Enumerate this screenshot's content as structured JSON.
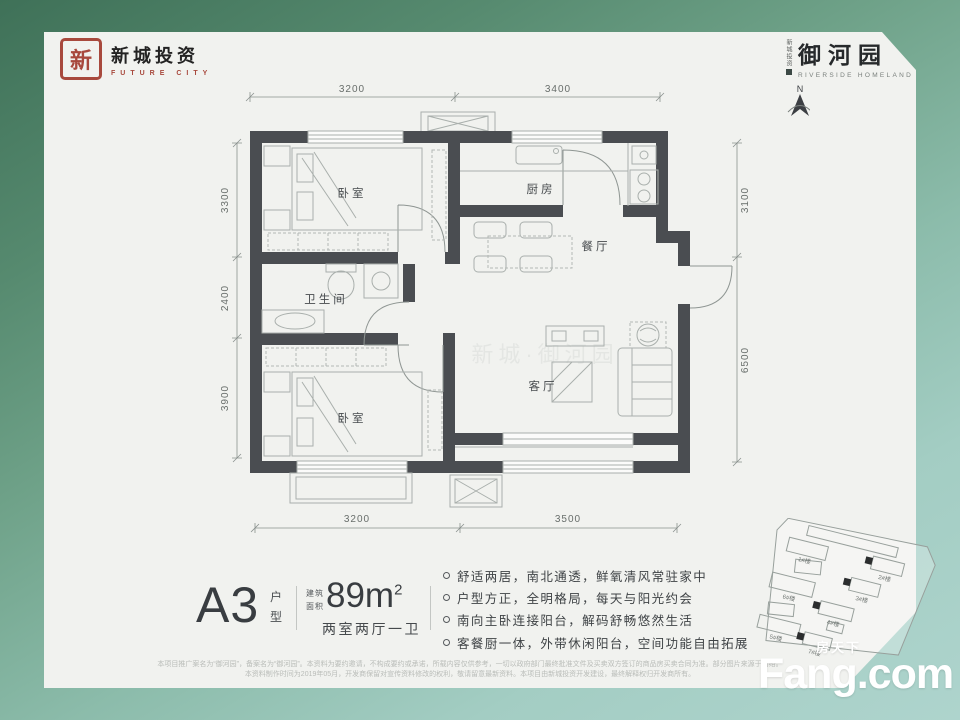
{
  "brand": {
    "developer": {
      "seal_char": "新",
      "name": "新城投资",
      "tagline": "FUTURE CITY"
    },
    "project": {
      "side_text": "新城投资",
      "name": "御河园",
      "tagline": "RIVERSIDE HOMELAND"
    }
  },
  "floorplan": {
    "compass_label": "N",
    "watermark": "新城·御河园",
    "rooms": {
      "bedroom_top": "卧室",
      "kitchen": "厨房",
      "dining": "餐厅",
      "bathroom": "卫生间",
      "bedroom_bottom": "卧室",
      "living": "客厅"
    },
    "dimensions": {
      "top": [
        "3200",
        "3400"
      ],
      "left": [
        "3300",
        "2400",
        "3900"
      ],
      "right": [
        "3100",
        "6500"
      ],
      "bottom": [
        "3200",
        "3500"
      ]
    }
  },
  "info": {
    "unit_code": "A3",
    "unit_label_top": "户",
    "unit_label_bottom": "型",
    "area_prefix_top": "建筑",
    "area_prefix_bottom": "面积",
    "area_value": "89m",
    "area_sup": "2",
    "layout_text": "两室两厅一卫",
    "features": [
      "舒适两居，南北通透，鲜氧清风常驻家中",
      "户型方正，全明格局，每天与阳光约会",
      "南向主卧连接阳台，解码舒畅悠然生活",
      "客餐厨一体，外带休闲阳台，空间功能自由拓展"
    ]
  },
  "siteplan": {
    "buildings": [
      "1#楼",
      "2#楼",
      "3#楼",
      "4#楼",
      "5#楼",
      "6#楼",
      "7#楼"
    ]
  },
  "footer": {
    "disclaimer_line1": "本项目推广案名为“御河园”，备案名为“御河园”。本资料为要约邀请，不构成要约或承诺，所载内容仅供参考，一切以政府部门最终批准文件及买卖双方签订的商品房买卖合同为准。部分图片来源于网络。",
    "disclaimer_line2": "本资料制作时间为2019年05月，开发商保留对宣传资料修改的权利，敬请留意最新资料。本项目由新城投资开发建设，最终解释权归开发商所有。",
    "watermark_cn": "房天下",
    "watermark_en": "Fang.com"
  }
}
